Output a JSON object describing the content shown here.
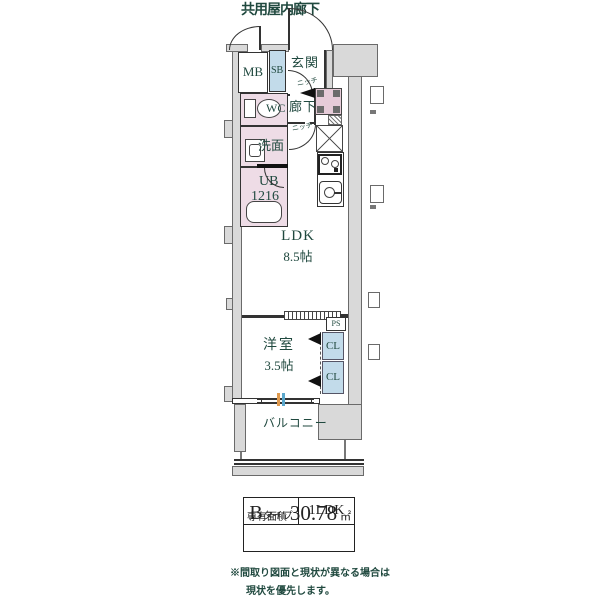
{
  "title": "共用屋内廊下",
  "rooms": {
    "mb": "MB",
    "sb": "SB",
    "genkan": {
      "label": "玄関",
      "niche": "ニッチ"
    },
    "hallway": {
      "label": "廊下",
      "niche": "ニッチ"
    },
    "wc": "WC",
    "washroom": "洗面",
    "bath": {
      "line1": "UB",
      "line2": "1216"
    },
    "ldk": {
      "name": "LDK",
      "size": "8.5帖"
    },
    "bedroom": {
      "name": "洋室",
      "size": "3.5帖"
    },
    "ps": "PS",
    "closet_top": "CL",
    "closet_bottom": "CL",
    "balcony": "バルコニー"
  },
  "info_table": {
    "type_main": "B",
    "type_sub": "タイプ",
    "layout": "1LDK",
    "area_label": "専有面積",
    "area_value": "30.78",
    "area_unit": "㎡"
  },
  "note": {
    "line1": "※間取り図面と現状が異なる場合は",
    "line2": "現状を優先します。"
  },
  "colors": {
    "wall_gray": "#d9d9d9",
    "wet_area_pink": "#eedce6",
    "washer_pink": "#e6cbd8",
    "closet_blue": "#c2dbea",
    "label_green": "#20493f",
    "line_dark": "#333333",
    "window_tick_orange": "#e09a4e",
    "window_tick_blue": "#5aa7cc"
  }
}
